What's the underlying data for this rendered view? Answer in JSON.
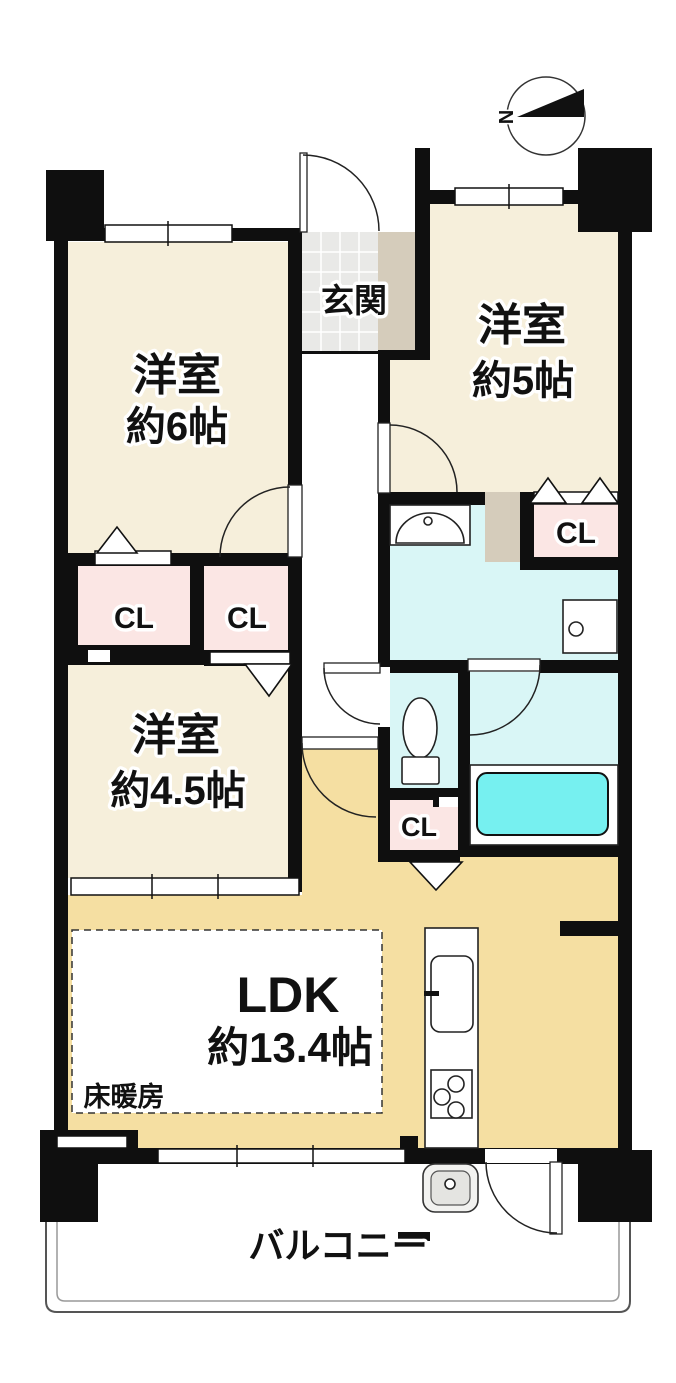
{
  "compass": {
    "north": "N"
  },
  "rooms": {
    "entrance": {
      "label": "玄関"
    },
    "west6": {
      "label": "洋室",
      "size": "約6帖"
    },
    "west5": {
      "label": "洋室",
      "size": "約5帖"
    },
    "west45": {
      "label": "洋室",
      "size": "約4.5帖"
    },
    "ldk": {
      "label": "LDK",
      "size": "約13.4帖",
      "floor_heating": "床暖房"
    },
    "balcony": {
      "label": "バルコニー"
    },
    "closet": {
      "label": "CL"
    }
  },
  "colors": {
    "wall": "#0f0f0f",
    "room_floor": "#f6efdb",
    "closet_floor": "#fbe6e4",
    "wet_floor": "#d9f6f6",
    "bathtub": "#76f0f0",
    "ldk_floor": "#f5dfa2",
    "tile_floor": "#e9e9e7",
    "step_strip": "#d5ccbb",
    "balcony_line": "#555555"
  }
}
